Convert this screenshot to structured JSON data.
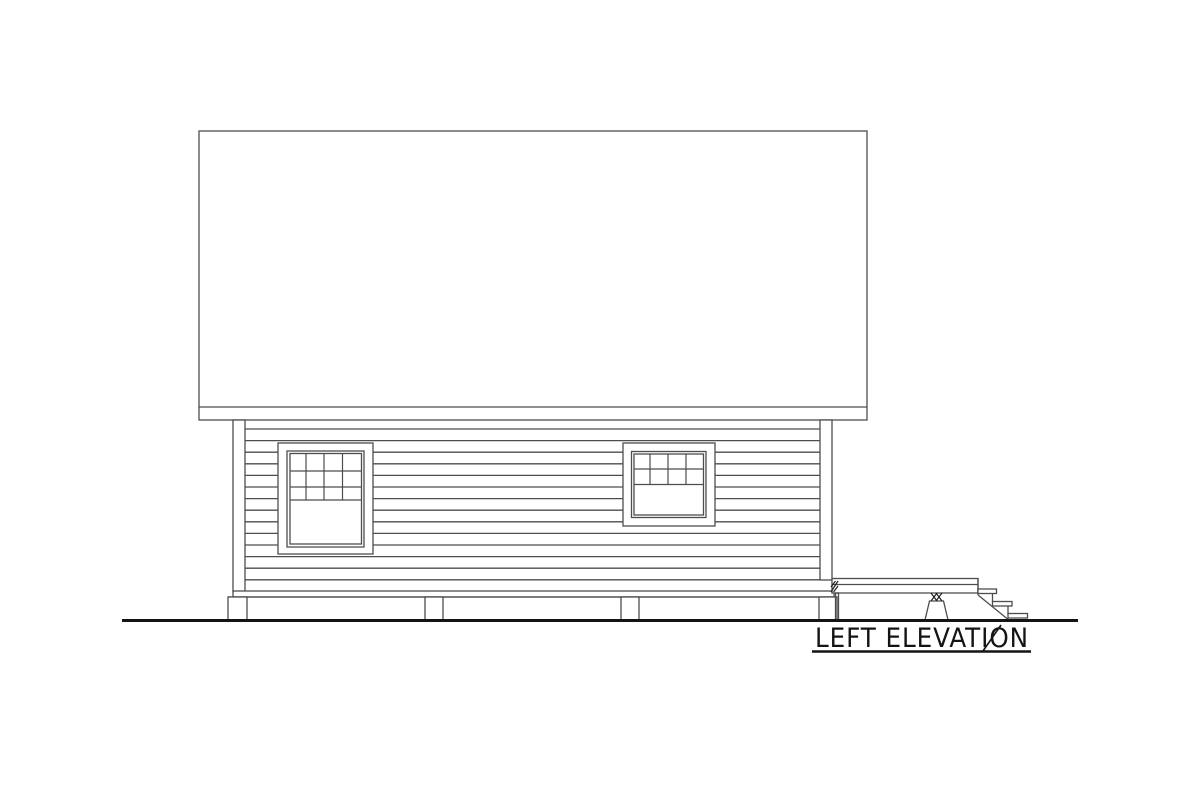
{
  "drawing": {
    "title": "LEFT ELEVATION",
    "type_note": "architectural side elevation line drawing",
    "colors": {
      "background": "#ffffff",
      "line": "#4d4d4d",
      "ink": "#141414"
    }
  }
}
